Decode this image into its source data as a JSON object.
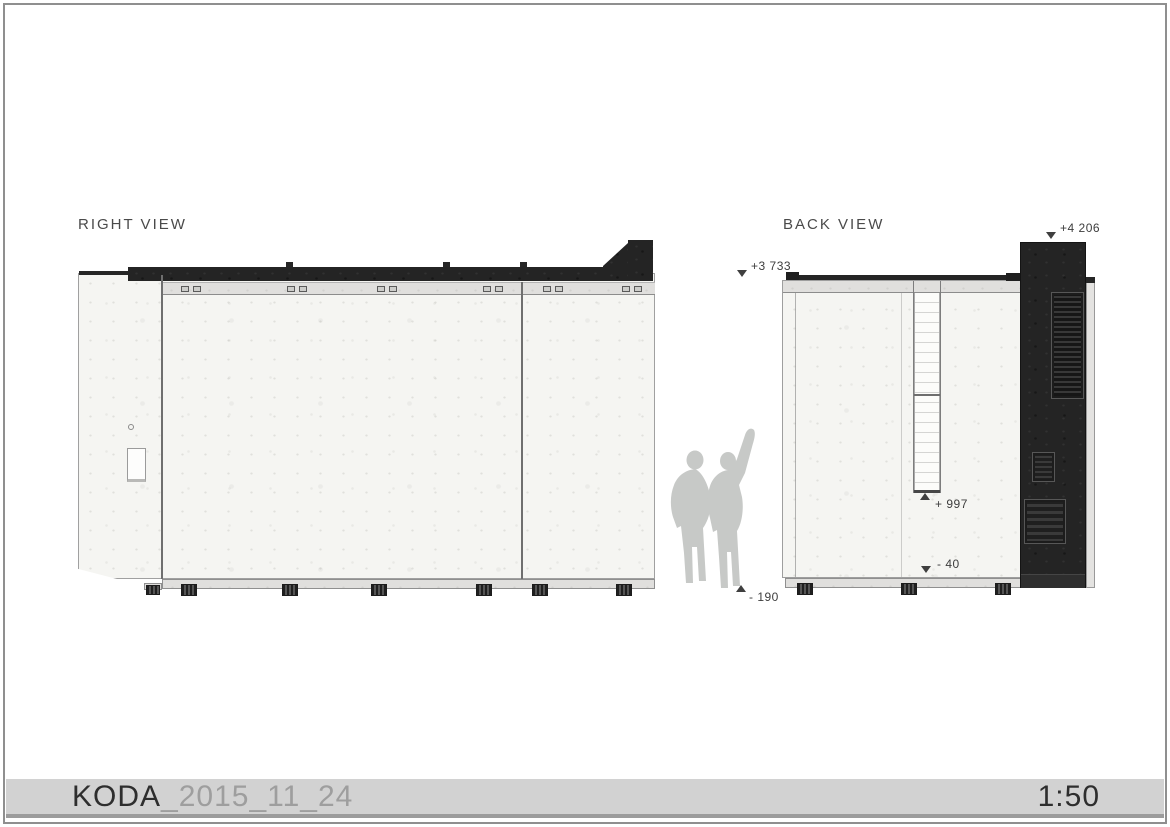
{
  "sheet": {
    "title": {
      "project": "KODA",
      "suffix": "_2015_11_24",
      "scale": "1:50"
    },
    "views": [
      {
        "id": "right",
        "label": "RIGHT VIEW"
      },
      {
        "id": "back",
        "label": "BACK VIEW"
      }
    ],
    "level_markers": [
      {
        "id": "back-roof-level",
        "label": "+3 733",
        "direction": "down"
      },
      {
        "id": "tower-top-level",
        "label": "+4 206",
        "direction": "down"
      },
      {
        "id": "ladder-foot-level",
        "label": "+ 997",
        "direction": "up"
      },
      {
        "id": "base-level",
        "label": "- 40",
        "direction": "down"
      },
      {
        "id": "ground-level",
        "label": "- 190",
        "direction": "up"
      }
    ],
    "colors": {
      "paper": "#ffffff",
      "frame_border": "#8f8f8f",
      "dark_cladding": "#242424",
      "concrete_wall": "#f5f5f2",
      "trim_band": "#e0dfdd",
      "silhouette": "#c7c9c7",
      "titlebar_bg": "#d2d2d2",
      "text_primary": "#2e2e2e",
      "text_muted": "#9e9e9e"
    }
  }
}
